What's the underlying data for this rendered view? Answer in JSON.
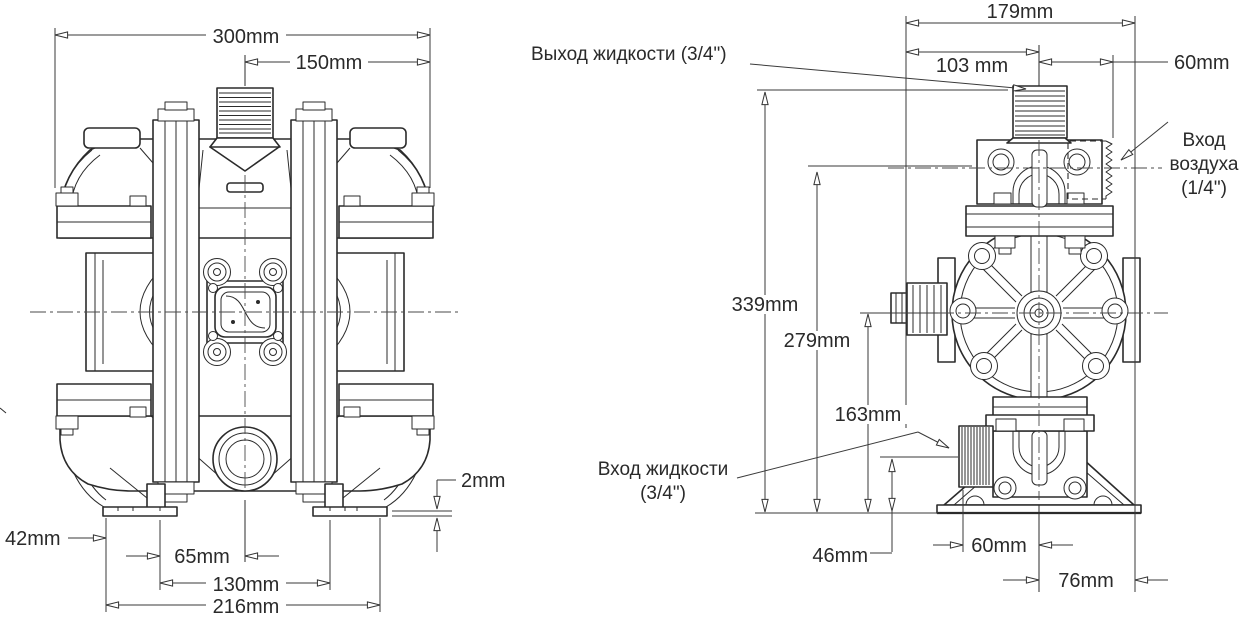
{
  "front_view": {
    "dimensions": {
      "overall_width": "300mm",
      "center_to_edge": "150mm",
      "edge_to_foot": "42mm",
      "foot_to_center": "65mm",
      "foot_inner_span": "130mm",
      "foot_outer_span": "216mm",
      "foot_plate_thickness": "2mm"
    }
  },
  "side_view": {
    "dimensions": {
      "overall_depth": "179mm",
      "outlet_offset": "103 mm",
      "center_to_air_inlet": "60mm",
      "overall_height": "339mm",
      "air_inlet_height": "279mm",
      "shaft_center_height": "163mm",
      "fluid_inlet_height": "46mm",
      "inlet_face_to_center": "60mm",
      "center_to_back_edge": "76mm"
    },
    "labels": {
      "fluid_outlet": "Выход жидкости (3/4\")",
      "air_inlet_line1": "Вход",
      "air_inlet_line2": "воздуха",
      "air_inlet_line3": "(1/4\")",
      "fluid_inlet_line1": "Вход жидкости",
      "fluid_inlet_line2": "(3/4\")"
    }
  }
}
